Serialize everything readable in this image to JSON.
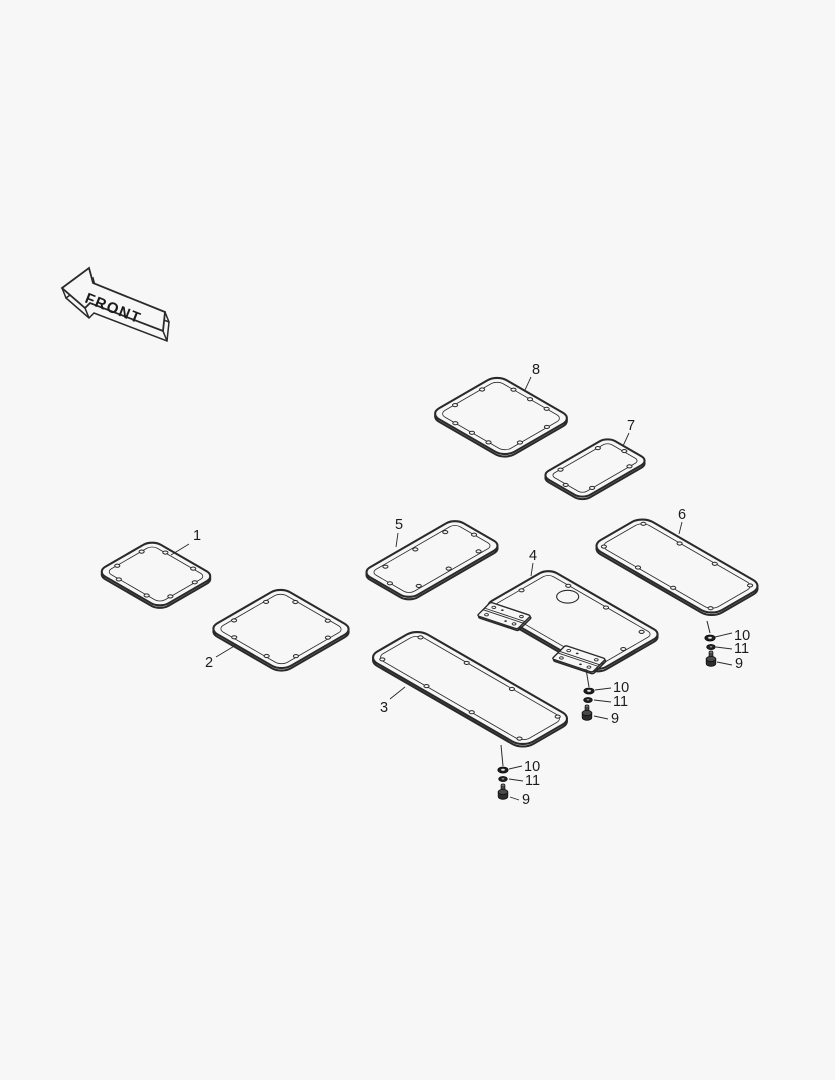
{
  "canvas": {
    "width": 835,
    "height": 1080,
    "background": "#f7f7f8",
    "line_color": "#2a2a2a",
    "fill_color": "#f7f7f8",
    "text_color": "#161616",
    "label_font_size": 14.5
  },
  "front_arrow": {
    "label": "FRONT"
  },
  "panels": [
    {
      "id": "1",
      "label": "1",
      "cx": 156,
      "cy": 574,
      "w": 73,
      "h": 64,
      "rx": 10,
      "label_x": 193,
      "label_y": 540,
      "leader": [
        189,
        544,
        171,
        555
      ],
      "holes": [
        [
          0.28,
          0.08
        ],
        [
          0.72,
          0.08
        ],
        [
          0.92,
          0.28
        ],
        [
          0.92,
          0.72
        ],
        [
          0.72,
          0.92
        ],
        [
          0.28,
          0.92
        ],
        [
          0.08,
          0.72
        ],
        [
          0.08,
          0.28
        ]
      ]
    },
    {
      "id": "2",
      "label": "2",
      "cx": 281,
      "cy": 629,
      "w": 85,
      "h": 84,
      "rx": 11,
      "label_x": 205,
      "label_y": 667,
      "leader": [
        216,
        657,
        236,
        645
      ],
      "holes": [
        [
          0.28,
          0.08
        ],
        [
          0.72,
          0.08
        ],
        [
          0.92,
          0.28
        ],
        [
          0.92,
          0.72
        ],
        [
          0.72,
          0.92
        ],
        [
          0.28,
          0.92
        ],
        [
          0.08,
          0.72
        ],
        [
          0.08,
          0.28
        ]
      ]
    },
    {
      "id": "3",
      "label": "3",
      "cx": 470,
      "cy": 688,
      "w": 180,
      "h": 58,
      "rx": 12,
      "label_x": 380,
      "label_y": 712,
      "leader": [
        390,
        699,
        405,
        687
      ],
      "holes": [
        [
          0.06,
          0.12
        ],
        [
          0.35,
          0.1
        ],
        [
          0.64,
          0.1
        ],
        [
          0.94,
          0.12
        ],
        [
          0.94,
          0.88
        ],
        [
          0.64,
          0.9
        ],
        [
          0.35,
          0.9
        ],
        [
          0.06,
          0.88
        ]
      ]
    },
    {
      "id": "4",
      "label": "4",
      "cx": 573,
      "cy": 620,
      "w": 132,
      "h": 75,
      "rx": 10,
      "label_x": 529,
      "label_y": 560,
      "leader": [
        533,
        563,
        531,
        576
      ],
      "holes": [
        [
          0.22,
          0.08
        ],
        [
          0.55,
          0.08
        ],
        [
          0.89,
          0.13
        ],
        [
          0.94,
          0.5
        ],
        [
          0.87,
          0.87
        ],
        [
          0.05,
          0.5
        ]
      ],
      "circle_hole": {
        "u": 0.3,
        "v": 0.23,
        "r": 9
      },
      "hinges": [
        0.165,
        0.82
      ]
    },
    {
      "id": "5",
      "label": "5",
      "cx": 432,
      "cy": 559,
      "w": 55,
      "h": 108,
      "rx": 10,
      "label_x": 395,
      "label_y": 529,
      "leader": [
        398,
        533,
        396,
        547
      ],
      "holes": [
        [
          0.5,
          0.05
        ],
        [
          0.85,
          0.18
        ],
        [
          0.85,
          0.5
        ],
        [
          0.85,
          0.82
        ],
        [
          0.5,
          0.95
        ],
        [
          0.15,
          0.82
        ],
        [
          0.15,
          0.5
        ],
        [
          0.15,
          0.18
        ]
      ]
    },
    {
      "id": "6",
      "label": "6",
      "cx": 677,
      "cy": 566,
      "w": 140,
      "h": 60,
      "rx": 12,
      "label_x": 678,
      "label_y": 519,
      "leader": [
        682,
        522,
        679,
        534
      ],
      "holes": [
        [
          0.06,
          0.12
        ],
        [
          0.35,
          0.1
        ],
        [
          0.64,
          0.1
        ],
        [
          0.94,
          0.12
        ],
        [
          0.94,
          0.88
        ],
        [
          0.64,
          0.9
        ],
        [
          0.35,
          0.9
        ],
        [
          0.06,
          0.88
        ]
      ]
    },
    {
      "id": "7",
      "label": "7",
      "cx": 595,
      "cy": 468,
      "w": 48,
      "h": 77,
      "rx": 9,
      "label_x": 627,
      "label_y": 430,
      "leader": [
        629,
        433,
        623,
        446
      ],
      "holes": [
        [
          0.5,
          0.06
        ],
        [
          0.88,
          0.22
        ],
        [
          0.88,
          0.78
        ],
        [
          0.5,
          0.94
        ],
        [
          0.12,
          0.78
        ],
        [
          0.12,
          0.22
        ]
      ]
    },
    {
      "id": "8",
      "label": "8",
      "cx": 501,
      "cy": 416,
      "w": 87,
      "h": 78,
      "rx": 11,
      "label_x": 532,
      "label_y": 374,
      "leader": [
        531,
        377,
        525,
        390
      ],
      "holes": [
        [
          0.28,
          0.07
        ],
        [
          0.5,
          0.07
        ],
        [
          0.72,
          0.07
        ],
        [
          0.93,
          0.3
        ],
        [
          0.93,
          0.7
        ],
        [
          0.72,
          0.93
        ],
        [
          0.5,
          0.93
        ],
        [
          0.28,
          0.93
        ],
        [
          0.07,
          0.7
        ],
        [
          0.07,
          0.3
        ]
      ]
    }
  ],
  "hardware_groups": [
    {
      "id": "right",
      "feed": [
        707,
        621,
        710,
        633
      ],
      "items": [
        {
          "type": "flat-washer",
          "label": "10",
          "x": 710,
          "y": 638,
          "label_x": 734,
          "label_y": 640,
          "leader": [
            715,
            637,
            732,
            633
          ]
        },
        {
          "type": "spring-washer",
          "label": "11",
          "x": 711,
          "y": 647,
          "label_x": 734,
          "label_y": 653,
          "leader": [
            716,
            647,
            732,
            649
          ]
        },
        {
          "type": "bolt",
          "label": "9",
          "x": 711,
          "y": 651,
          "label_x": 735,
          "label_y": 668,
          "leader": [
            717,
            662,
            732,
            665
          ]
        }
      ]
    },
    {
      "id": "middle",
      "feed": [
        586,
        669,
        589,
        687
      ],
      "items": [
        {
          "type": "flat-washer",
          "label": "10",
          "x": 589,
          "y": 691,
          "label_x": 613,
          "label_y": 692,
          "leader": [
            595,
            690,
            611,
            688
          ]
        },
        {
          "type": "spring-washer",
          "label": "11",
          "x": 588,
          "y": 700,
          "label_x": 613,
          "label_y": 706,
          "leader": [
            594,
            700,
            611,
            702
          ]
        },
        {
          "type": "bolt",
          "label": "9",
          "x": 587,
          "y": 705,
          "label_x": 611,
          "label_y": 723,
          "leader": [
            594,
            716,
            608,
            719
          ]
        }
      ]
    },
    {
      "id": "left",
      "feed": [
        501,
        745,
        503,
        766
      ],
      "items": [
        {
          "type": "flat-washer",
          "label": "10",
          "x": 503,
          "y": 770,
          "label_x": 524,
          "label_y": 771,
          "leader": [
            509,
            769,
            522,
            766
          ]
        },
        {
          "type": "spring-washer",
          "label": "11",
          "x": 503,
          "y": 779,
          "label_x": 525,
          "label_y": 785,
          "leader": [
            509,
            779,
            523,
            781
          ]
        },
        {
          "type": "bolt",
          "label": "9",
          "x": 503,
          "y": 784,
          "label_x": 522,
          "label_y": 804,
          "leader": [
            510,
            797,
            519,
            800
          ]
        }
      ]
    }
  ]
}
